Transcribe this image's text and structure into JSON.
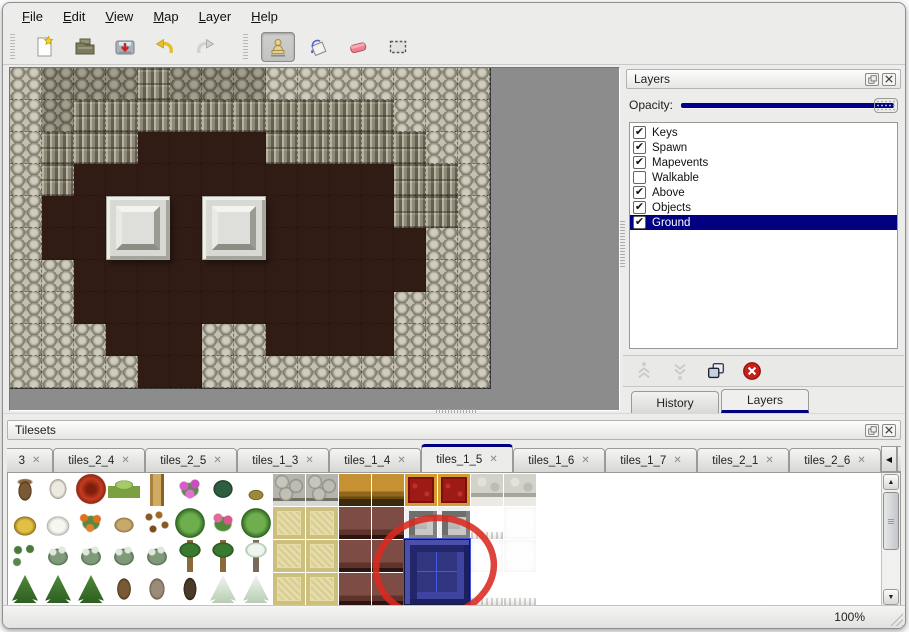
{
  "menu_bar": {
    "items": [
      {
        "label": "File"
      },
      {
        "label": "Edit"
      },
      {
        "label": "View"
      },
      {
        "label": "Map"
      },
      {
        "label": "Layer"
      },
      {
        "label": "Help"
      }
    ]
  },
  "toolbar": {
    "groups": [
      {
        "buttons": [
          {
            "icon": "new-file",
            "active": false
          },
          {
            "icon": "open-file",
            "active": false
          },
          {
            "icon": "save-file",
            "active": false
          },
          {
            "icon": "undo",
            "active": false
          },
          {
            "icon": "redo",
            "active": false
          }
        ]
      },
      {
        "buttons": [
          {
            "icon": "stamp-tool",
            "active": true
          },
          {
            "icon": "fill-tool",
            "active": false
          },
          {
            "icon": "eraser-tool",
            "active": false
          },
          {
            "icon": "rect-select-tool",
            "active": false
          }
        ]
      }
    ]
  },
  "map_view": {
    "tile_size": 32,
    "legend": {
      "L": "light-rock-scales",
      "D": "dark-rock-scales",
      "C": "cliff-face",
      "F": "brown-cobble-floor"
    },
    "grid": [
      "LDDDCDDDLLLLLLL",
      "LDCCCCCCCCCCLLL",
      "LCCCFFFFCCCCCLL",
      "LCFFFFFFFFFFCCL",
      "LFFFFFFFFFFFCCL",
      "LFFFFFFFFFFFFLL",
      "LLFFFFFFFFFFFLL",
      "LLFFFFFFFFFFLLL",
      "LLLFFFLLFFFFLLL",
      "LLLLFFLLLLLLLLL"
    ],
    "pillars": [
      {
        "col": 3,
        "row": 4
      },
      {
        "col": 6,
        "row": 4
      }
    ]
  },
  "layers_panel": {
    "title": "Layers",
    "opacity_label": "Opacity:",
    "opacity_value": 100,
    "layers": [
      {
        "name": "Keys",
        "checked": true,
        "selected": false
      },
      {
        "name": "Spawn",
        "checked": true,
        "selected": false
      },
      {
        "name": "Mapevents",
        "checked": true,
        "selected": false
      },
      {
        "name": "Walkable",
        "checked": false,
        "selected": false
      },
      {
        "name": "Above",
        "checked": true,
        "selected": false
      },
      {
        "name": "Objects",
        "checked": true,
        "selected": false
      },
      {
        "name": "Ground",
        "checked": true,
        "selected": true
      }
    ],
    "buttons": [
      {
        "icon": "move-layer-up",
        "enabled": false
      },
      {
        "icon": "move-layer-down",
        "enabled": false
      },
      {
        "icon": "duplicate-layer",
        "enabled": true
      },
      {
        "icon": "delete-layer",
        "enabled": true
      }
    ],
    "tabs": [
      {
        "label": "History",
        "active": false
      },
      {
        "label": "Layers",
        "active": true
      }
    ]
  },
  "tilesets_panel": {
    "title": "Tilesets",
    "tabs": [
      {
        "label": "3",
        "active": false,
        "clipped": true
      },
      {
        "label": "tiles_2_4",
        "active": false
      },
      {
        "label": "tiles_2_5",
        "active": false
      },
      {
        "label": "tiles_1_3",
        "active": false
      },
      {
        "label": "tiles_1_4",
        "active": false
      },
      {
        "label": "tiles_1_5",
        "active": true
      },
      {
        "label": "tiles_1_6",
        "active": false
      },
      {
        "label": "tiles_1_7",
        "active": false
      },
      {
        "label": "tiles_2_1",
        "active": false
      },
      {
        "label": "tiles_2_6",
        "active": false
      }
    ],
    "tile_grid": [
      [
        "trunk",
        "dead-tree-white",
        "red-flower",
        "stump",
        "tall-trunk",
        "pink-flowers",
        "fern",
        "dry-plant",
        "stone",
        "stone",
        "wood",
        "wood",
        "red-carpet",
        "red-carpet",
        "silver",
        "silver"
      ],
      [
        "hay-mound",
        "snow-mound",
        "orange-flowers",
        "dry-grass",
        "leaves",
        "lily-pad",
        "rose-bush",
        "lily-pad",
        "tatami",
        "tatami",
        "maroon",
        "maroon",
        "steel",
        "steel",
        "curtain-fringe",
        "white"
      ],
      [
        "sprouts",
        "bush",
        "bush",
        "bush",
        "bush",
        "palm",
        "palm",
        "snow-palm",
        "tatami",
        "tatami",
        "maroon",
        "maroon",
        "blue-sel",
        "blue-sel",
        "white",
        "white"
      ],
      [
        "pine",
        "pine",
        "pine",
        "twisted-trunk",
        "dead-tree",
        "dark-trunk",
        "snow-pine",
        "snow-pine",
        "tatami",
        "tatami",
        "maroon",
        "maroon",
        "blue-sel",
        "blue-sel",
        "curtain-fringe",
        "curtain-fringe"
      ]
    ],
    "selected_tile": {
      "col": 12,
      "row": 2,
      "colspan": 2,
      "rowspan": 2,
      "name": "blue-beveled-tile"
    },
    "annotation": "red-circle-around-selected-tile"
  },
  "status_bar": {
    "zoom": "100%"
  },
  "colors": {
    "accent_navy": "#000080",
    "selection_navy": "#000080",
    "annotation_red": "#da2a20",
    "canvas_gray": "#8c8c8c"
  }
}
